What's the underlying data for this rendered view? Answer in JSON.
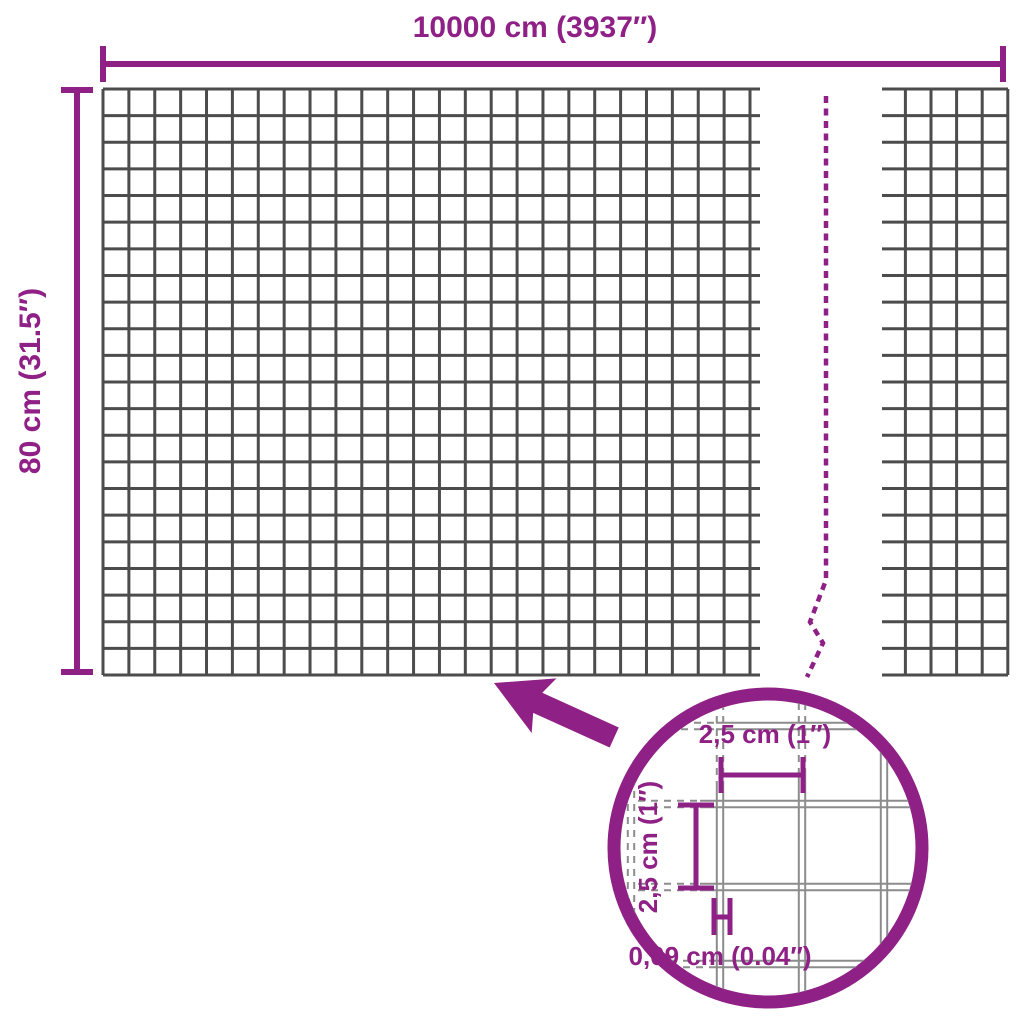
{
  "colors": {
    "accent": "#8f2086",
    "grid_line": "#4c4c4c",
    "wire_line": "#8c8c8c",
    "background": "#ffffff"
  },
  "labels": {
    "roll_width": "10000 cm (3937″)",
    "roll_height": "80 cm (31.5″)",
    "mesh_cell_width": "2,5 cm (1″)",
    "mesh_cell_height": "2,5 cm (1″)",
    "wire_thickness": "0,09 cm (0.04″)"
  }
}
